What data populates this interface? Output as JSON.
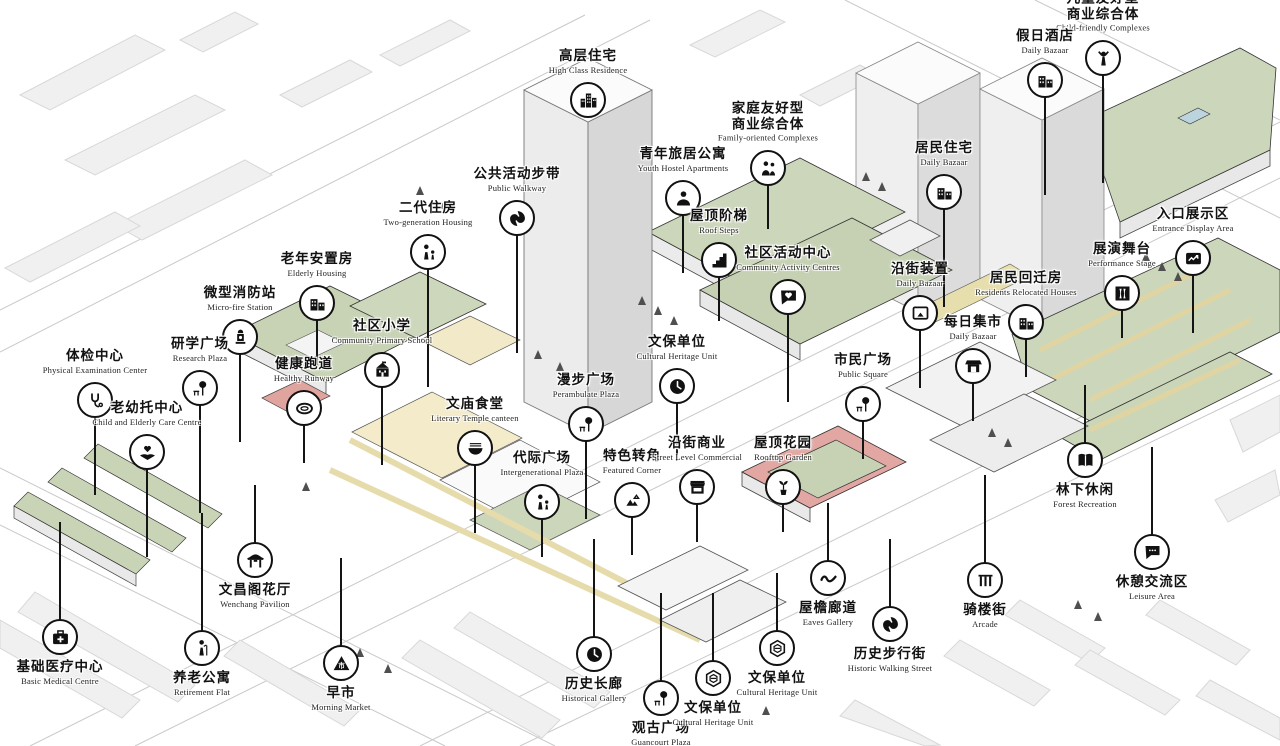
{
  "palette": {
    "outline": "#1a1a1a",
    "icon_bg": "#ffffff",
    "icon_fg": "#111111",
    "roof_green": "#ccd6bb",
    "park_green": "#cbd5b8",
    "path_yellow": "#e6dcab",
    "accent_red": "#e2a7a2",
    "building_light": "#f0f0f0",
    "building_side": "#d9d9d9",
    "road_line": "#c9c9c9",
    "pool_blue": "#bcd4de"
  },
  "callouts": [
    {
      "id": "high-class-residence",
      "zh": "高层住宅",
      "en": "High Class Residence",
      "icon": "city-buildings",
      "x": 588,
      "y": 100,
      "label_pos": "above",
      "line": 0
    },
    {
      "id": "child-friendly-complexes",
      "zh": "儿童友好型\n商业综合体",
      "en": "Child-friendly Complexes",
      "icon": "child-figure",
      "x": 1103,
      "y": 58,
      "label_pos": "above",
      "line": 110
    },
    {
      "id": "holiday-hotel",
      "zh": "假日酒店",
      "en": "Daily Bazaar",
      "icon": "row-buildings",
      "x": 1045,
      "y": 80,
      "label_pos": "above",
      "line": 100
    },
    {
      "id": "family-oriented-complexes",
      "zh": "家庭友好型\n商业综合体",
      "en": "Family-oriented Complexes",
      "icon": "family-figures",
      "x": 768,
      "y": 168,
      "label_pos": "above",
      "line": 46
    },
    {
      "id": "youth-hostel-apartments",
      "zh": "青年旅居公寓",
      "en": "Youth Hostel Apartments",
      "icon": "person-figure",
      "x": 683,
      "y": 198,
      "label_pos": "above",
      "line": 60
    },
    {
      "id": "residents-housing",
      "zh": "居民住宅",
      "en": "Daily Bazaar",
      "icon": "row-buildings",
      "x": 944,
      "y": 192,
      "label_pos": "above",
      "line": 100
    },
    {
      "id": "entrance-display-area",
      "zh": "入口展示区",
      "en": "Entrance Display Area",
      "icon": "photo-chart",
      "x": 1193,
      "y": 258,
      "label_pos": "above",
      "line": 60
    },
    {
      "id": "performance-stage",
      "zh": "展演舞台",
      "en": "Performance Stage",
      "icon": "stage-curtain",
      "x": 1122,
      "y": 293,
      "label_pos": "above",
      "line": 30
    },
    {
      "id": "public-walkway",
      "zh": "公共活动步带",
      "en": "Public Walkway",
      "icon": "walkway-swirl",
      "x": 517,
      "y": 218,
      "label_pos": "above",
      "line": 120
    },
    {
      "id": "two-generation-housing",
      "zh": "二代住房",
      "en": "Two-generation Housing",
      "icon": "adult-child-figures",
      "x": 428,
      "y": 252,
      "label_pos": "above",
      "line": 120
    },
    {
      "id": "roof-steps",
      "zh": "屋顶阶梯",
      "en": "Roof Steps",
      "icon": "stairs",
      "x": 719,
      "y": 260,
      "label_pos": "above",
      "line": 46
    },
    {
      "id": "community-activity-centre",
      "zh": "社区活动中心",
      "en": "Community Activity Centres",
      "icon": "chat-heart",
      "x": 788,
      "y": 297,
      "label_pos": "above",
      "line": 90
    },
    {
      "id": "street-installation",
      "zh": "沿街装置",
      "en": "Daily Bazaar",
      "icon": "artwork-frame",
      "x": 920,
      "y": 313,
      "label_pos": "above",
      "line": 60
    },
    {
      "id": "residents-relocated-houses",
      "zh": "居民回迁房",
      "en": "Residents Relocated Houses",
      "icon": "row-buildings",
      "x": 1026,
      "y": 322,
      "label_pos": "above",
      "line": 40
    },
    {
      "id": "elderly-housing",
      "zh": "老年安置房",
      "en": "Elderly Housing",
      "icon": "row-buildings",
      "x": 317,
      "y": 303,
      "label_pos": "above",
      "line": 50
    },
    {
      "id": "micro-fire-station",
      "zh": "微型消防站",
      "en": "Micro-fire Station",
      "icon": "fire-hydrant",
      "x": 240,
      "y": 337,
      "label_pos": "above",
      "line": 90
    },
    {
      "id": "research-plaza",
      "zh": "研学广场",
      "en": "Research Plaza",
      "icon": "tree-bench",
      "x": 200,
      "y": 388,
      "label_pos": "above",
      "line": 110
    },
    {
      "id": "physical-examination-center",
      "zh": "体检中心",
      "en": "Physical Examination Center",
      "icon": "stethoscope",
      "x": 95,
      "y": 400,
      "label_pos": "above",
      "line": 80
    },
    {
      "id": "healthy-runway",
      "zh": "健康跑道",
      "en": "Healthy Runway",
      "icon": "running-track",
      "x": 304,
      "y": 408,
      "label_pos": "above",
      "line": 40
    },
    {
      "id": "community-primary-school",
      "zh": "社区小学",
      "en": "Community Primary School",
      "icon": "school-building",
      "x": 382,
      "y": 370,
      "label_pos": "above",
      "line": 80
    },
    {
      "id": "child-and-elderly-care-centre",
      "zh": "老幼托中心",
      "en": "Child and Elderly Care Centre",
      "icon": "hands-heart",
      "x": 147,
      "y": 452,
      "label_pos": "above",
      "line": 90
    },
    {
      "id": "literary-temple-canteen",
      "zh": "文庙食堂",
      "en": "Literary Temple canteen",
      "icon": "noodle-bowl",
      "x": 475,
      "y": 448,
      "label_pos": "above",
      "line": 70
    },
    {
      "id": "perambulate-plaza",
      "zh": "漫步广场",
      "en": "Perambulate Plaza",
      "icon": "tree-bench",
      "x": 586,
      "y": 424,
      "label_pos": "above",
      "line": 80
    },
    {
      "id": "cultural-heritage-unit-1",
      "zh": "文保单位",
      "en": "Cultural Heritage Unit",
      "icon": "clock",
      "x": 677,
      "y": 386,
      "label_pos": "above",
      "line": 60
    },
    {
      "id": "public-square",
      "zh": "市民广场",
      "en": "Public Square",
      "icon": "tree-bench",
      "x": 863,
      "y": 404,
      "label_pos": "above",
      "line": 40
    },
    {
      "id": "daily-bazaar-market",
      "zh": "每日集市",
      "en": "Daily Bazaar",
      "icon": "market-stall",
      "x": 973,
      "y": 366,
      "label_pos": "above",
      "line": 40
    },
    {
      "id": "intergenerational-plaza",
      "zh": "代际广场",
      "en": "Intergenerational Plaza",
      "icon": "adult-child-figures",
      "x": 542,
      "y": 502,
      "label_pos": "above",
      "line": 40
    },
    {
      "id": "featured-corner",
      "zh": "特色转角",
      "en": "Featured Corner",
      "icon": "corner-triangles",
      "x": 632,
      "y": 500,
      "label_pos": "above",
      "line": 40
    },
    {
      "id": "street-level-commercial",
      "zh": "沿街商业",
      "en": "Street Level Commercial",
      "icon": "storefront",
      "x": 697,
      "y": 487,
      "label_pos": "above",
      "line": 40
    },
    {
      "id": "rooftop-garden",
      "zh": "屋顶花园",
      "en": "Rooftop Garden",
      "icon": "potted-plant",
      "x": 783,
      "y": 487,
      "label_pos": "above",
      "line": 30
    },
    {
      "id": "forest-recreation",
      "zh": "林下休闲",
      "en": "Forest Recreation",
      "icon": "open-book",
      "x": 1085,
      "y": 460,
      "label_pos": "below",
      "line": 60
    },
    {
      "id": "leisure-area",
      "zh": "休憩交流区",
      "en": "Leisure Area",
      "icon": "chat-bubble",
      "x": 1152,
      "y": 552,
      "label_pos": "below",
      "line": 90
    },
    {
      "id": "arcade-street",
      "zh": "骑楼街",
      "en": "Arcade",
      "icon": "arcade-columns",
      "x": 985,
      "y": 580,
      "label_pos": "below",
      "line": 90
    },
    {
      "id": "eaves-gallery",
      "zh": "屋檐廊道",
      "en": "Eaves Gallery",
      "icon": "wave-line",
      "x": 828,
      "y": 578,
      "label_pos": "below",
      "line": 60
    },
    {
      "id": "historic-walking-street",
      "zh": "历史步行街",
      "en": "Historic Walking Street",
      "icon": "spiral-swirl",
      "x": 890,
      "y": 624,
      "label_pos": "below",
      "line": 70
    },
    {
      "id": "cultural-heritage-unit-2",
      "zh": "文保单位",
      "en": "Cultural Heritage Unit",
      "icon": "hexagon-emblem",
      "x": 777,
      "y": 648,
      "label_pos": "below",
      "line": 60
    },
    {
      "id": "historical-gallery",
      "zh": "历史长廊",
      "en": "Historical Gallery",
      "icon": "clock",
      "x": 594,
      "y": 654,
      "label_pos": "below",
      "line": 100
    },
    {
      "id": "guancourt-plaza",
      "zh": "观古广场",
      "en": "Guancourt Plaza",
      "icon": "tree-bench",
      "x": 661,
      "y": 698,
      "label_pos": "below",
      "line": 90
    },
    {
      "id": "cultural-heritage-unit-3",
      "zh": "文保单位",
      "en": "Cultural Heritage Unit",
      "icon": "hexagon-emblem",
      "x": 713,
      "y": 678,
      "label_pos": "below",
      "line": 70
    },
    {
      "id": "morning-market",
      "zh": "早市",
      "en": "Morning Market",
      "icon": "market-triangle",
      "x": 341,
      "y": 663,
      "label_pos": "below",
      "line": 90
    },
    {
      "id": "wenchang-pavilion",
      "zh": "文昌阁花厅",
      "en": "Wenchang Pavilion",
      "icon": "pavilion",
      "x": 255,
      "y": 560,
      "label_pos": "below",
      "line": 60
    },
    {
      "id": "retirement-flat",
      "zh": "养老公寓",
      "en": "Retirement Flat",
      "icon": "elderly-cane",
      "x": 202,
      "y": 648,
      "label_pos": "below",
      "line": 120
    },
    {
      "id": "basic-medical-centre",
      "zh": "基础医疗中心",
      "en": "Basic Medical Centre",
      "icon": "medical-kit",
      "x": 60,
      "y": 637,
      "label_pos": "below",
      "line": 100
    }
  ]
}
